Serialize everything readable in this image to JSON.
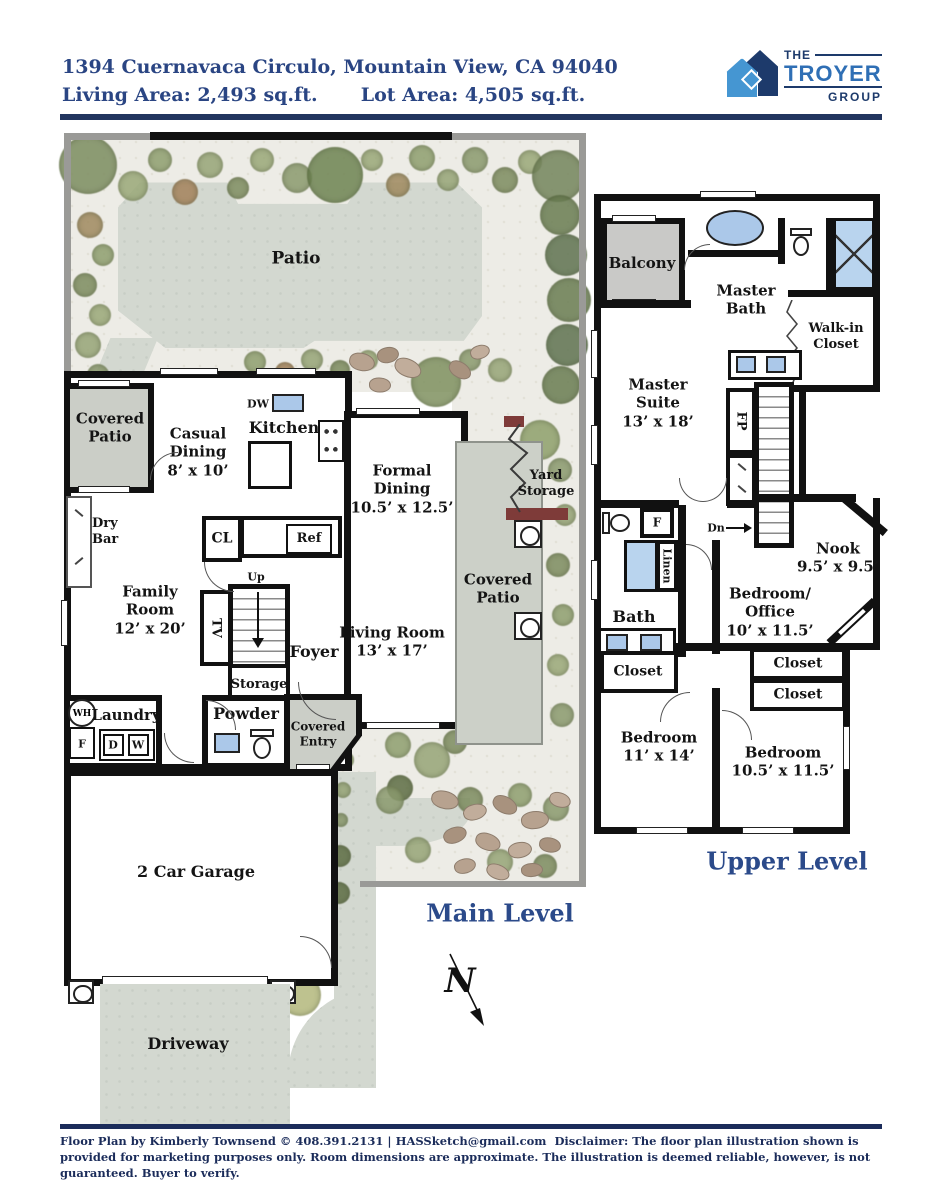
{
  "header": {
    "address": "1394 Cuernavaca Circulo, Mountain View, CA 94040",
    "living_area": "Living Area: 2,493 sq.ft.",
    "lot_area": "Lot Area: 4,505 sq.ft."
  },
  "logo": {
    "the": "THE",
    "troyer": "TROYER",
    "group": "GROUP"
  },
  "colors": {
    "navy_text": "#2a4583",
    "title_navy": "#2b4a8a",
    "logo_light_blue": "#4596d2",
    "logo_dark_navy": "#1d3a6b",
    "troyer_blue": "#2f6fb5",
    "wall_black": "#111111",
    "patio_gray": "#cbcec7",
    "fixture_blue": "#abc8e9",
    "gate_maroon": "#7e3b39"
  },
  "main": {
    "title": "Main Level",
    "compass": "N",
    "patio": "Patio",
    "covered_patio_nw": "Covered Patio",
    "casual_dining": {
      "name": "Casual Dining",
      "dims": "8’ x 10’"
    },
    "kitchen": "Kitchen",
    "dw": "DW",
    "formal_dining": {
      "name": "Formal Dining",
      "dims": "10.5’ x 12.5’"
    },
    "yard_storage": "Yard Storage",
    "dry_bar": "Dry Bar",
    "cl": "CL",
    "ref": "Ref",
    "family_room": {
      "name": "Family Room",
      "dims": "12’ x 20’"
    },
    "tv": "TV",
    "up": "Up",
    "foyer": "Foyer",
    "living_room": {
      "name": "Living Room",
      "dims": "13’ x 17’"
    },
    "covered_patio_e": "Covered Patio",
    "storage": "Storage",
    "wh": "WH",
    "laundry": "Laundry",
    "f": "F",
    "d": "D",
    "w": "W",
    "powder": "Powder",
    "covered_entry": "Covered Entry",
    "garage": "2 Car Garage",
    "driveway": "Driveway"
  },
  "upper": {
    "title": "Upper Level",
    "balcony": "Balcony",
    "master_bath": "Master Bath",
    "walk_in_closet": "Walk-in Closet",
    "master_suite": {
      "name": "Master Suite",
      "dims": "13’ x 18’"
    },
    "fp": "FP",
    "dn": "Dn",
    "nook": {
      "name": "Nook",
      "dims": "9.5’ x 9.5’"
    },
    "bath": "Bath",
    "f": "F",
    "linen": "Linen",
    "bedroom_office": {
      "name": "Bedroom/ Office",
      "dims": "10’ x 11.5’"
    },
    "closet_w": "Closet",
    "closet_e1": "Closet",
    "closet_e2": "Closet",
    "bedroom_sw": {
      "name": "Bedroom",
      "dims": "11’ x 14’"
    },
    "bedroom_se": {
      "name": "Bedroom",
      "dims": "10.5’ x 11.5’"
    }
  },
  "footer": {
    "credit": "Floor Plan by Kimberly Townsend ©   408.391.2131    |    HASSketch@gmail.com",
    "disclaimer": "Disclaimer: The floor plan illustration shown is provided for marketing purposes only. Room dimensions are approximate. The illustration is deemed reliable, however, is not guaranteed. Buyer to verify."
  }
}
